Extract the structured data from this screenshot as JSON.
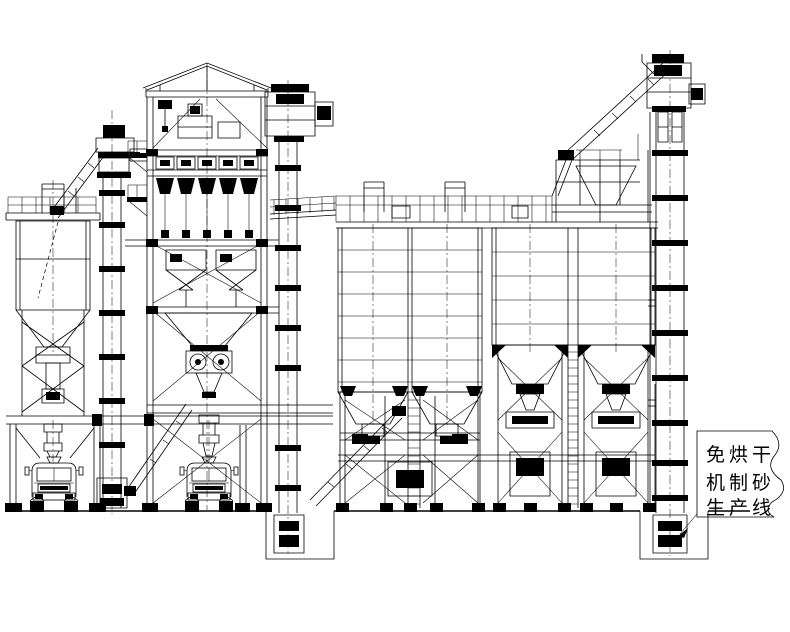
{
  "drawing": {
    "background": "#ffffff",
    "line_color": "#000000",
    "annotation": {
      "lines": [
        "免烘干",
        "机制砂",
        "生产线"
      ]
    }
  }
}
